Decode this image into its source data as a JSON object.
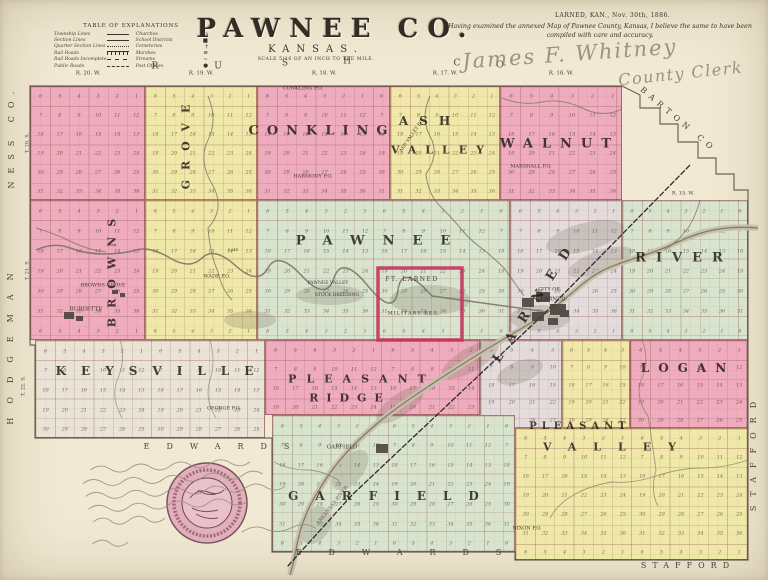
{
  "header": {
    "title": "PAWNEE CO.",
    "subtitle": "KANSAS.",
    "scale_note": "SCALE 5/16 OF AN INCH TO THE MILE.",
    "legend": {
      "title": "TABLE OF EXPLANATIONS",
      "left_items": [
        {
          "label": "Township Lines",
          "style": "township"
        },
        {
          "label": "Section Lines",
          "style": "section"
        },
        {
          "label": "Quarter Section Lines",
          "style": "quarter"
        },
        {
          "label": "Rail Roads",
          "style": "rail"
        },
        {
          "label": "Rail Roads Incomplete",
          "style": "rail2"
        },
        {
          "label": "Public Roads",
          "style": "road"
        }
      ],
      "right_items": [
        {
          "label": "Churches",
          "icon": "⌂"
        },
        {
          "label": "School Districts",
          "icon": "■"
        },
        {
          "label": "Cemeteries",
          "icon": "†"
        },
        {
          "label": "Marshes",
          "icon": "≡"
        },
        {
          "label": "Streams",
          "icon": "~"
        },
        {
          "label": "Post Offices",
          "icon": "●"
        }
      ]
    },
    "certification": {
      "dateline": "LARNED, KAN., Nov. 30th, 1886.",
      "text": "Having examined the annexed Map of Pawnee County, Kansas, I believe the same to have been compiled with care and accuracy.",
      "signature": "James F. Whitney",
      "signature_title": "County Clerk"
    }
  },
  "map": {
    "colors": {
      "pink": "#efacbe",
      "yellow": "#f0e8a8",
      "green": "#d9e4cf",
      "gray": "#eae4d6",
      "lavender": "#e4dcdc",
      "paper": "#f1e9d3",
      "fort_red": "#c5335c",
      "ink": "#3a332b",
      "water": "#75705f",
      "hand": "#97907f",
      "seal_pink": "#e2a9ba",
      "seal_ink": "#6d4450"
    },
    "townships": [
      {
        "id": "browns-grove-north",
        "color": "pink",
        "x": 30,
        "y": 86,
        "w": 115,
        "h": 114
      },
      {
        "id": "grove-strip-north",
        "color": "yellow",
        "x": 145,
        "y": 86,
        "w": 112,
        "h": 114
      },
      {
        "id": "conkling",
        "color": "pink",
        "x": 257,
        "y": 86,
        "w": 133,
        "h": 114
      },
      {
        "id": "ash-valley",
        "color": "yellow",
        "x": 390,
        "y": 86,
        "w": 110,
        "h": 114
      },
      {
        "id": "walnut",
        "color": "pink",
        "x": 500,
        "y": 86,
        "w": 122,
        "h": 114
      },
      {
        "id": "browns-grove-south",
        "color": "pink",
        "x": 30,
        "y": 200,
        "w": 115,
        "h": 140
      },
      {
        "id": "grove-strip-south",
        "color": "yellow",
        "x": 145,
        "y": 200,
        "w": 112,
        "h": 140
      },
      {
        "id": "pawnee",
        "color": "green",
        "x": 257,
        "y": 200,
        "w": 253,
        "h": 140
      },
      {
        "id": "larned-west",
        "color": "lavender",
        "x": 510,
        "y": 200,
        "w": 112,
        "h": 140
      },
      {
        "id": "river",
        "color": "green",
        "x": 622,
        "y": 200,
        "w": 126,
        "h": 140
      },
      {
        "id": "larned-wedge",
        "color": "lavender",
        "x": 480,
        "y": 340,
        "w": 82,
        "h": 88
      },
      {
        "id": "keysville",
        "color": "gray",
        "x": 35,
        "y": 340,
        "w": 230,
        "h": 98
      },
      {
        "id": "pleasant-ridge",
        "color": "pink",
        "x": 265,
        "y": 340,
        "w": 215,
        "h": 75
      },
      {
        "id": "pleasant-valley-north",
        "color": "yellow",
        "x": 562,
        "y": 340,
        "w": 68,
        "h": 88
      },
      {
        "id": "logan",
        "color": "pink",
        "x": 630,
        "y": 340,
        "w": 118,
        "h": 88
      },
      {
        "id": "garfield",
        "color": "green",
        "x": 272,
        "y": 415,
        "w": 243,
        "h": 137
      },
      {
        "id": "pleasant-valley",
        "color": "yellow",
        "x": 515,
        "y": 428,
        "w": 233,
        "h": 132
      }
    ],
    "names": [
      {
        "id": "grove",
        "text": "GROVE",
        "x": 186,
        "y": 142,
        "rot": -90,
        "fs": 11,
        "ls": 10
      },
      {
        "id": "browns",
        "text": "BROWNS",
        "x": 112,
        "y": 268,
        "rot": -90,
        "fs": 11,
        "ls": 10
      },
      {
        "id": "conkling",
        "text": "CONKLING",
        "x": 322,
        "y": 131,
        "fs": 13,
        "ls": 8
      },
      {
        "id": "ash",
        "text": "ASH",
        "x": 430,
        "y": 121,
        "fs": 12,
        "ls": 11
      },
      {
        "id": "ash-valley",
        "text": "VALLEY",
        "x": 442,
        "y": 150,
        "fs": 11,
        "ls": 9
      },
      {
        "id": "walnut",
        "text": "WALNUT",
        "x": 560,
        "y": 144,
        "fs": 13,
        "ls": 9
      },
      {
        "id": "pawnee",
        "text": "PAWNEE",
        "x": 382,
        "y": 241,
        "fs": 13,
        "ls": 18
      },
      {
        "id": "river",
        "text": "RIVER",
        "x": 684,
        "y": 258,
        "fs": 13,
        "ls": 10
      },
      {
        "id": "larned",
        "text": "LARNED",
        "x": 536,
        "y": 300,
        "rot": -57,
        "fs": 13,
        "ls": 14
      },
      {
        "id": "keysville",
        "text": "KEYSVILLE",
        "x": 162,
        "y": 371,
        "fs": 12,
        "ls": 15
      },
      {
        "id": "pleasant",
        "text": "PLEASANT",
        "x": 362,
        "y": 379,
        "fs": 11,
        "ls": 10
      },
      {
        "id": "ridge",
        "text": "RIDGE",
        "x": 350,
        "y": 398,
        "fs": 11,
        "ls": 8
      },
      {
        "id": "logan",
        "text": "LOGAN",
        "x": 688,
        "y": 368,
        "fs": 12,
        "ls": 9
      },
      {
        "id": "pleasant-v",
        "text": "PLEASANT",
        "x": 580,
        "y": 427,
        "fs": 10,
        "ls": 5
      },
      {
        "id": "valley-v",
        "text": "VALLEY",
        "x": 618,
        "y": 447,
        "fs": 11,
        "ls": 17
      },
      {
        "id": "garfield",
        "text": "GARFIELD",
        "x": 392,
        "y": 496,
        "fs": 12,
        "ls": 17
      }
    ],
    "places": [
      {
        "id": "conkling-po",
        "text": "CONKLING P.O.",
        "x": 303,
        "y": 89
      },
      {
        "id": "harmony-po",
        "text": "HARMONY P.O.",
        "x": 313,
        "y": 177
      },
      {
        "id": "ash-valley-po",
        "text": "ASH VALLEY P.O.",
        "x": 413,
        "y": 136,
        "rot": -55,
        "fs": 4.5
      },
      {
        "id": "marshall-po",
        "text": "MARSHALL P.O.",
        "x": 531,
        "y": 167
      },
      {
        "id": "wade-po",
        "text": "WADE P.O.",
        "x": 217,
        "y": 277
      },
      {
        "id": "browns-grove-town",
        "text": "BROWNS GROVE",
        "x": 103,
        "y": 286
      },
      {
        "id": "burdette-town",
        "text": "BURDETTE",
        "x": 86,
        "y": 310,
        "fs": 5.5
      },
      {
        "id": "city-of",
        "text": "CITY OF",
        "x": 549,
        "y": 290
      },
      {
        "id": "larned-city",
        "text": "LARNED",
        "x": 553,
        "y": 300,
        "fs": 5.5
      },
      {
        "id": "george-po",
        "text": "GEORGE P.O.",
        "x": 224,
        "y": 409
      },
      {
        "id": "garfield-town",
        "text": "GARFIELD",
        "x": 342,
        "y": 448,
        "fs": 5.5
      },
      {
        "id": "nixon-po",
        "text": "NIXON P.O.",
        "x": 527,
        "y": 529
      },
      {
        "id": "ft-larned",
        "text": "FT. LARNED",
        "x": 412,
        "y": 280,
        "fs": 6,
        "ls": 1.5
      },
      {
        "id": "military-res",
        "text": "MILITARY RES.",
        "x": 414,
        "y": 314,
        "fs": 5,
        "ls": 1
      },
      {
        "id": "pawnee-valley-farm-1",
        "text": "PAWNEE VALLEY",
        "x": 328,
        "y": 284,
        "fs": 4.5
      },
      {
        "id": "pawnee-valley-farm-2",
        "text": "STOCK BREEDING",
        "x": 337,
        "y": 296,
        "fs": 4.5
      },
      {
        "id": "arkansas-river-label",
        "text": "ARKANSAS RIVER",
        "x": 333,
        "y": 506,
        "rot": -52,
        "fs": 5,
        "italic": true,
        "color": "#6d665a"
      },
      {
        "id": "elevation-2244",
        "text": "2244",
        "x": 233,
        "y": 250,
        "fs": 4
      }
    ],
    "border_labels": [
      {
        "id": "ness-co",
        "text": "NESS CO.",
        "x": 12,
        "y": 136,
        "rot": -90,
        "fs": 8,
        "ls": 8
      },
      {
        "id": "hodgeman",
        "text": "HODGEMAN",
        "x": 11,
        "y": 342,
        "rot": -90,
        "fs": 8,
        "ls": 14
      },
      {
        "id": "rush-r",
        "text": "R",
        "x": 155,
        "y": 67,
        "fs": 9
      },
      {
        "id": "rush-u",
        "text": "U",
        "x": 218,
        "y": 67,
        "fs": 9
      },
      {
        "id": "rush-s",
        "text": "S",
        "x": 285,
        "y": 64,
        "fs": 9
      },
      {
        "id": "rush-h",
        "text": "H",
        "x": 347,
        "y": 62,
        "fs": 9
      },
      {
        "id": "rush-c",
        "text": "C",
        "x": 457,
        "y": 64,
        "fs": 9
      },
      {
        "id": "rush-o",
        "text": "O",
        "x": 500,
        "y": 66,
        "fs": 9
      },
      {
        "id": "barton-co",
        "text": "BARTON CO",
        "x": 678,
        "y": 120,
        "rot": 40,
        "fs": 8,
        "ls": 5
      },
      {
        "id": "stafford-east",
        "text": "STAFFORD",
        "x": 754,
        "y": 452,
        "rot": -90,
        "fs": 8,
        "ls": 9
      },
      {
        "id": "edwards-west",
        "text": "EDWARDS",
        "x": 225,
        "y": 447,
        "fs": 8,
        "ls": 17
      },
      {
        "id": "edwards-south",
        "text": "EDWARDS",
        "x": 412,
        "y": 553,
        "fs": 8,
        "ls": 27
      },
      {
        "id": "stafford-south",
        "text": "STAFFORD",
        "x": 688,
        "y": 566,
        "fs": 8,
        "ls": 6
      }
    ],
    "range_labels": [
      {
        "id": "r20w",
        "text": "R. 20. W.",
        "x": 88,
        "y": 74,
        "fs": 5.5
      },
      {
        "id": "r19w",
        "text": "R. 19. W.",
        "x": 201,
        "y": 74,
        "fs": 5.5
      },
      {
        "id": "r18w",
        "text": "R. 18. W.",
        "x": 324,
        "y": 74,
        "fs": 5.5
      },
      {
        "id": "r17w",
        "text": "R. 17. W.",
        "x": 445,
        "y": 74,
        "fs": 5.5
      },
      {
        "id": "r16w",
        "text": "R. 16. W.",
        "x": 561,
        "y": 74,
        "fs": 5.5
      },
      {
        "id": "r15w",
        "text": "R. 15. W.",
        "x": 683,
        "y": 194,
        "fs": 5
      }
    ],
    "township_row_labels": [
      {
        "id": "t20s",
        "text": "T. 20. S.",
        "x": 28,
        "y": 143,
        "rot": -90,
        "fs": 5
      },
      {
        "id": "t21s",
        "text": "T. 21. S.",
        "x": 28,
        "y": 270,
        "rot": -90,
        "fs": 5
      },
      {
        "id": "t22s",
        "text": "T. 22. S.",
        "x": 24,
        "y": 386,
        "rot": -90,
        "fs": 5
      }
    ],
    "fort": {
      "outline_color": "#c5335c"
    }
  }
}
